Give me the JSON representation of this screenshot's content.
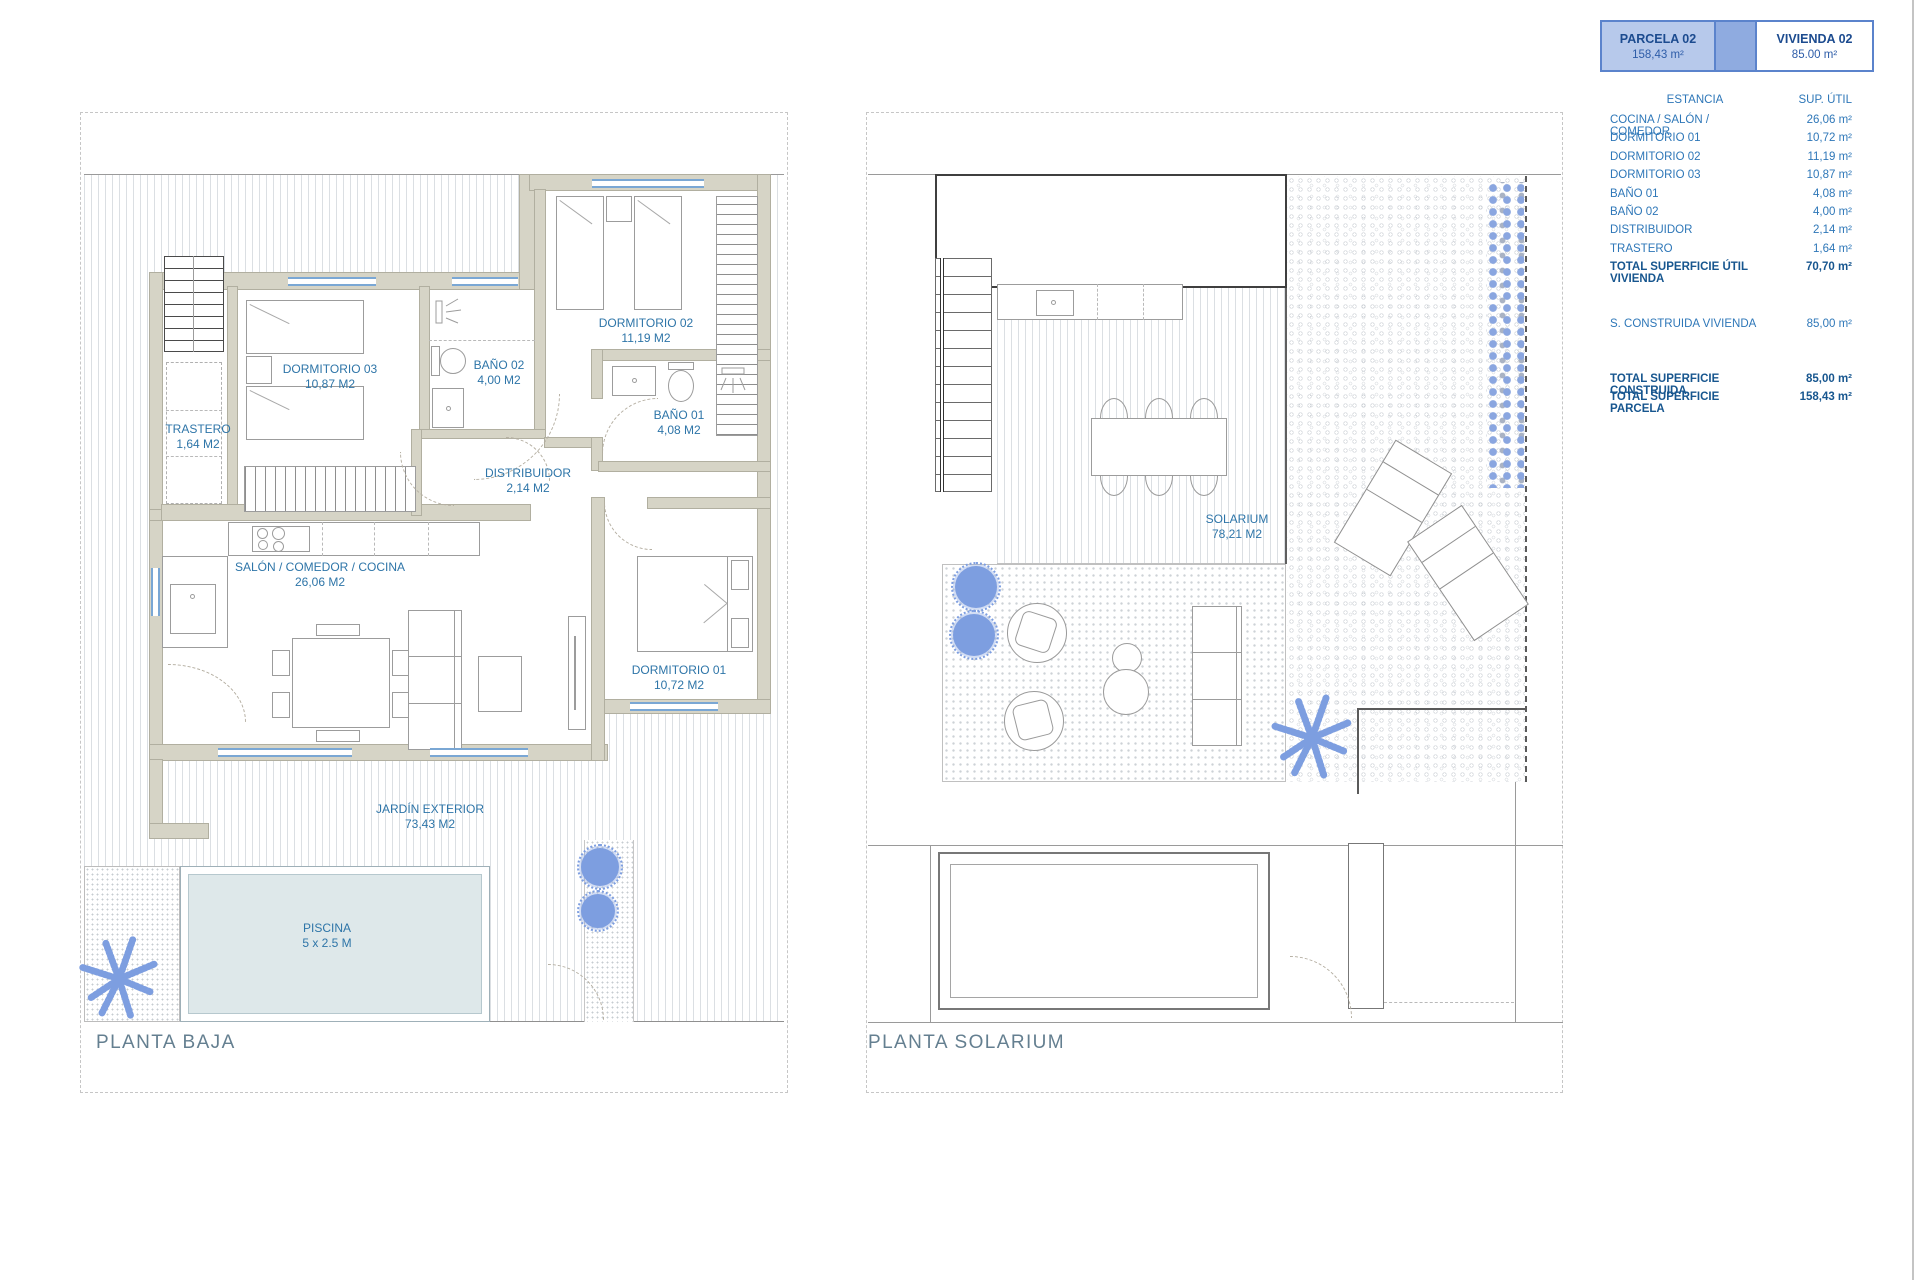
{
  "header_card": {
    "parcela_label": "PARCELA 02",
    "parcela_area": "158,43 m²",
    "vivienda_label": "VIVIENDA 02",
    "vivienda_area": "85.00 m²"
  },
  "legend": {
    "col_estancia": "ESTANCIA",
    "col_sup": "SUP.  ÚTIL",
    "rows": [
      {
        "label": "COCINA / SALÓN / COMEDOR",
        "value": "26,06 m²",
        "bold": false
      },
      {
        "label": "DORMITORIO 01",
        "value": "10,72 m²",
        "bold": false
      },
      {
        "label": "DORMITORIO 02",
        "value": "11,19 m²",
        "bold": false
      },
      {
        "label": "DORMITORIO 03",
        "value": "10,87 m²",
        "bold": false
      },
      {
        "label": "BAÑO 01",
        "value": "4,08 m²",
        "bold": false
      },
      {
        "label": "BAÑO 02",
        "value": "4,00 m²",
        "bold": false
      },
      {
        "label": "DISTRIBUIDOR",
        "value": "2,14 m²",
        "bold": false
      },
      {
        "label": "TRASTERO",
        "value": "1,64 m²",
        "bold": false
      },
      {
        "label": "TOTAL SUPERFICIE ÚTIL VIVIENDA",
        "value": "70,70 m²",
        "bold": true
      }
    ],
    "construida_label": "S. CONSTRUIDA VIVIENDA",
    "construida_value": "85,00 m²",
    "totals": [
      {
        "label": "TOTAL SUPERFICIE CONSTRUIDA",
        "value": "85,00 m²"
      },
      {
        "label": "TOTAL SUPERFICIE PARCELA",
        "value": "158,43 m²"
      }
    ]
  },
  "floor_plans": {
    "planta_baja": {
      "title": "PLANTA BAJA",
      "room_labels": [
        {
          "name": "TRASTERO",
          "area": "1,64 M2",
          "x": 198,
          "y": 422
        },
        {
          "name": "DORMITORIO 03",
          "area": "10,87 M2",
          "x": 330,
          "y": 362
        },
        {
          "name": "BAÑO 02",
          "area": "4,00 M2",
          "x": 499,
          "y": 358
        },
        {
          "name": "DORMITORIO 02",
          "area": "11,19 M2",
          "x": 646,
          "y": 316
        },
        {
          "name": "BAÑO 01",
          "area": "4,08 M2",
          "x": 679,
          "y": 408
        },
        {
          "name": "DISTRIBUIDOR",
          "area": "2,14 M2",
          "x": 528,
          "y": 466
        },
        {
          "name": "SALÓN / COMEDOR / COCINA",
          "area": "26,06 M2",
          "x": 320,
          "y": 560
        },
        {
          "name": "DORMITORIO 01",
          "area": "10,72 M2",
          "x": 679,
          "y": 663
        },
        {
          "name": "JARDÍN EXTERIOR",
          "area": "73,43 M2",
          "x": 430,
          "y": 802
        },
        {
          "name": "PISCINA",
          "area": "5 x 2.5 M",
          "x": 327,
          "y": 921
        }
      ]
    },
    "planta_solarium": {
      "title": "PLANTA SOLARIUM",
      "room_labels": [
        {
          "name": "SOLARIUM",
          "area": "78,21 M2",
          "x": 1237,
          "y": 512
        }
      ]
    }
  },
  "colors": {
    "room_label_text": "#2e75a8",
    "plan_title_text": "#647f90",
    "legend_text": "#2e77b8",
    "legend_bold_text": "#17568f",
    "card_light_blue": "#b7c9eb",
    "card_mid_blue": "#8fabe0",
    "card_border_blue": "#5b83cc",
    "window_blue": "#7aa7d4",
    "wall_fill": "#d6d4c6",
    "pool_fill": "#dee8ea",
    "plant_blue": "#7d9ee0"
  }
}
